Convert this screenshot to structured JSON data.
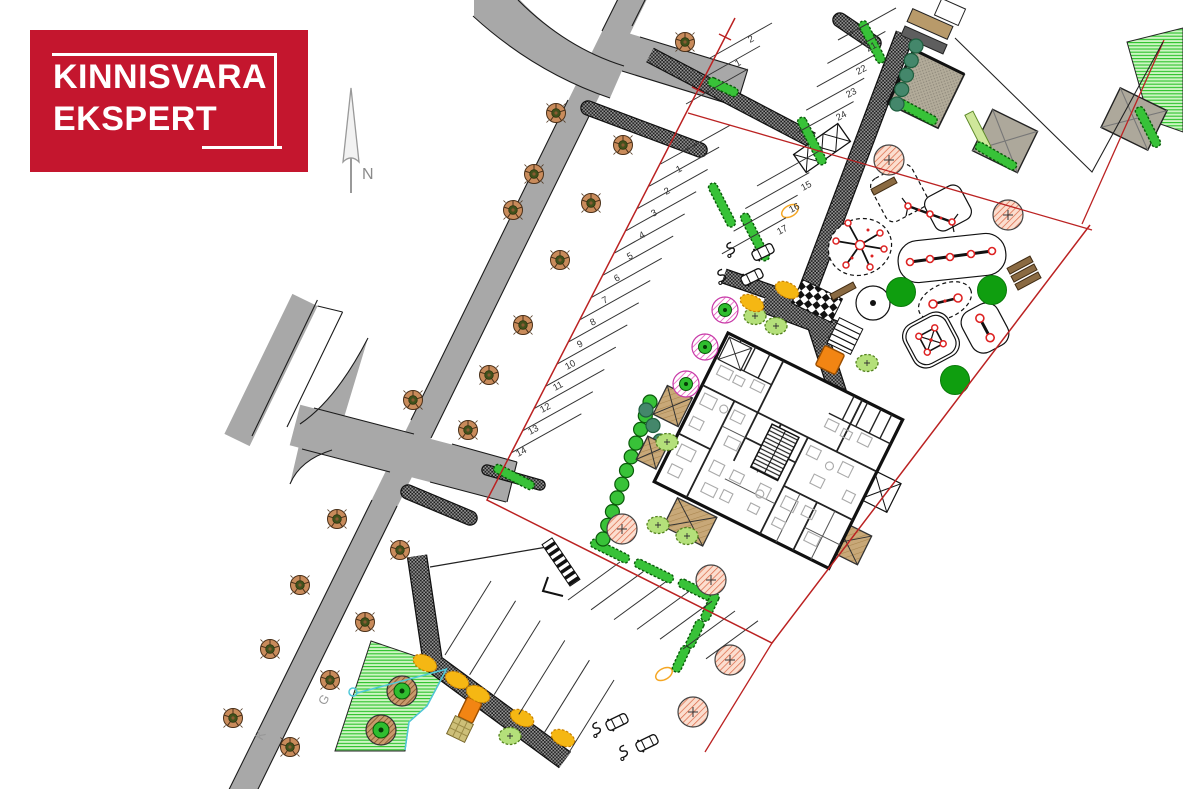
{
  "brand": {
    "line1": "KINNISVARA",
    "line2": "EKSPERT",
    "bg": "#C4162E"
  },
  "compass": {
    "label": "N"
  },
  "street_labels": [
    {
      "t": "G",
      "x": 325,
      "y": 706,
      "r": -60
    },
    {
      "t": "K",
      "x": 262,
      "y": 741,
      "r": -60
    }
  ],
  "parking_rows": [
    {
      "name": "main",
      "count": 14,
      "ax": 660.6,
      "ay": 164,
      "sx": -11.48,
      "sy": 22.22,
      "dx": 70,
      "dy": -39,
      "labels": [
        {
          "t": "1",
          "x": 678,
          "y": 173
        },
        {
          "t": "2",
          "x": 666,
          "y": 195
        },
        {
          "t": "3",
          "x": 653,
          "y": 217
        },
        {
          "t": "4",
          "x": 641,
          "y": 239
        },
        {
          "t": "5",
          "x": 629,
          "y": 260
        },
        {
          "t": "6",
          "x": 616,
          "y": 282
        },
        {
          "t": "7",
          "x": 604,
          "y": 304
        },
        {
          "t": "8",
          "x": 592,
          "y": 326
        },
        {
          "t": "9",
          "x": 579,
          "y": 348
        },
        {
          "t": "10",
          "x": 567,
          "y": 370
        },
        {
          "t": "11",
          "x": 555,
          "y": 391
        },
        {
          "t": "12",
          "x": 542,
          "y": 413
        },
        {
          "t": "13",
          "x": 530,
          "y": 435
        },
        {
          "t": "14",
          "x": 518,
          "y": 457
        }
      ]
    },
    {
      "name": "top",
      "count": 3,
      "ax": 710,
      "ay": 58,
      "sx": -12,
      "sy": 23,
      "dx": 62,
      "dy": -35,
      "labels": [
        {
          "t": "2",
          "x": 750,
          "y": 43
        },
        {
          "t": "1",
          "x": 737,
          "y": 67
        }
      ]
    },
    {
      "name": "northeast",
      "count": 5,
      "ax": 838,
      "ay": 40,
      "sx": -10.6,
      "sy": 23.4,
      "dx": 58,
      "dy": -32,
      "labels": [
        {
          "t": "21",
          "x": 868,
          "y": 52
        },
        {
          "t": "22",
          "x": 858,
          "y": 75
        },
        {
          "t": "23",
          "x": 848,
          "y": 98
        },
        {
          "t": "24",
          "x": 838,
          "y": 121
        }
      ]
    },
    {
      "name": "mid",
      "count": 4,
      "ax": 757,
      "ay": 186,
      "sx": -11.7,
      "sy": 22.6,
      "dx": 64,
      "dy": -36,
      "labels": [
        {
          "t": "15",
          "x": 803,
          "y": 191
        },
        {
          "t": "16",
          "x": 791,
          "y": 213
        },
        {
          "t": "17",
          "x": 779,
          "y": 235
        }
      ]
    },
    {
      "name": "south-upper",
      "count": 7,
      "ax": 568,
      "ay": 600,
      "sx": 23,
      "sy": 9.8,
      "dx": 52,
      "dy": -38,
      "labels": []
    },
    {
      "name": "south-lower",
      "count": 6,
      "ax": 445,
      "ay": 655,
      "sx": 24.6,
      "sy": 19.8,
      "dx": 46,
      "dy": -74,
      "labels": []
    }
  ],
  "plan": {
    "colors": {
      "road": "#A8A8A8",
      "red_boundary": "#BB2222",
      "hedge": "#38C238",
      "accent_orange": "#F28513",
      "cyan": "#4FC8D8"
    },
    "trees": {
      "street": [
        [
          685,
          42
        ],
        [
          556,
          113
        ],
        [
          623,
          145
        ],
        [
          534,
          174
        ],
        [
          513,
          210
        ],
        [
          591,
          203
        ],
        [
          560,
          260
        ],
        [
          523,
          325
        ],
        [
          489,
          375
        ],
        [
          413,
          400
        ],
        [
          468,
          430
        ],
        [
          337,
          519
        ],
        [
          400,
          550
        ],
        [
          300,
          585
        ],
        [
          365,
          622
        ],
        [
          270,
          649
        ],
        [
          330,
          680
        ],
        [
          233,
          718
        ],
        [
          290,
          747
        ]
      ],
      "salmon": [
        [
          889,
          160
        ],
        [
          1008,
          215
        ],
        [
          622,
          529
        ],
        [
          711,
          580
        ],
        [
          730,
          660
        ],
        [
          693,
          712
        ]
      ],
      "pink": [
        [
          725,
          310
        ],
        [
          705,
          347
        ],
        [
          686,
          384
        ]
      ],
      "lawn_ring": [
        [
          402,
          691
        ],
        [
          381,
          730
        ]
      ],
      "green_solid": [
        [
          901,
          292
        ],
        [
          992,
          290
        ],
        [
          955,
          380
        ]
      ],
      "bush_light": [
        [
          755,
          316
        ],
        [
          776,
          326
        ],
        [
          667,
          442
        ],
        [
          658,
          525
        ],
        [
          687,
          536
        ],
        [
          510,
          736
        ],
        [
          867,
          363
        ]
      ],
      "bush_yellow": [
        [
          425,
          663
        ],
        [
          457,
          680
        ],
        [
          478,
          694
        ],
        [
          522,
          718
        ],
        [
          563,
          738
        ],
        [
          752,
          303
        ],
        [
          787,
          290
        ]
      ]
    },
    "hedges": {
      "bars": [
        [
          723,
          87,
          32,
          25
        ],
        [
          812,
          141,
          52,
          63
        ],
        [
          872,
          42,
          46,
          63
        ],
        [
          917,
          112,
          44,
          28
        ],
        [
          996,
          156,
          46,
          30
        ],
        [
          1148,
          127,
          44,
          63
        ],
        [
          755,
          237,
          52,
          63
        ],
        [
          722,
          205,
          48,
          63
        ],
        [
          610,
          551,
          42,
          26
        ],
        [
          654,
          571,
          42,
          26
        ],
        [
          696,
          590,
          38,
          26
        ],
        [
          710,
          607,
          30,
          115
        ],
        [
          695,
          634,
          30,
          115
        ],
        [
          681,
          659,
          28,
          115
        ],
        [
          514,
          477,
          44,
          27
        ]
      ],
      "scallops": [
        {
          "x1": 916,
          "y1": 46,
          "x2": 897,
          "y2": 104,
          "n": 5,
          "dark": true
        },
        {
          "x1": 650,
          "y1": 402,
          "x2": 603,
          "y2": 539,
          "n": 11,
          "dark": false
        },
        {
          "x1": 646,
          "y1": 410,
          "x2": 660,
          "y2": 441,
          "n": 3,
          "dark": true
        }
      ]
    },
    "vehicles": {
      "cars": [
        [
          763,
          252,
          -26
        ],
        [
          752,
          277,
          -26
        ],
        [
          617,
          722,
          -26
        ],
        [
          647,
          743,
          -26
        ]
      ],
      "scooters": [
        [
          731,
          249,
          -26
        ],
        [
          722,
          276,
          -26
        ],
        [
          597,
          729,
          -26
        ],
        [
          624,
          752,
          -26
        ]
      ]
    },
    "benches": [
      [
        1020,
        265,
        -28
      ],
      [
        1024,
        273,
        -28
      ],
      [
        1028,
        281,
        -28
      ],
      [
        884,
        186,
        -28
      ],
      [
        843,
        291,
        -28
      ]
    ]
  }
}
